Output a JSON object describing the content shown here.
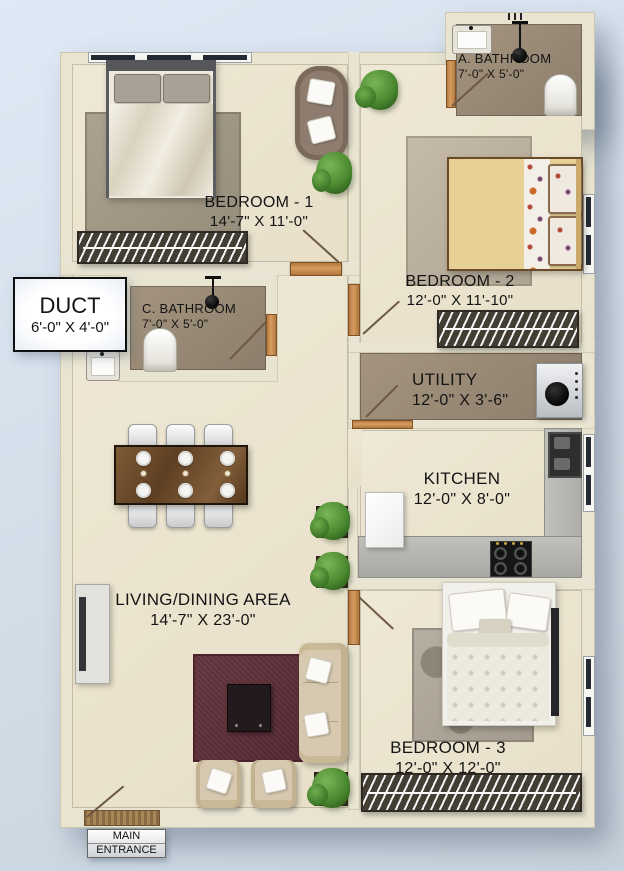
{
  "rooms": [
    {
      "id": "a-bathroom",
      "name": "A. BATHROOM",
      "dims": "7'-0\" X 5'-0\""
    },
    {
      "id": "bedroom-1",
      "name": "BEDROOM - 1",
      "dims": "14'-7\" X 11'-0\""
    },
    {
      "id": "bedroom-2",
      "name": "BEDROOM - 2",
      "dims": "12'-0\" X 11'-10\""
    },
    {
      "id": "duct",
      "name": "DUCT",
      "dims": "6'-0\" X 4'-0\""
    },
    {
      "id": "c-bathroom",
      "name": "C. BATHROOM",
      "dims": "7'-0\" X 5'-0\""
    },
    {
      "id": "utility",
      "name": "UTILITY",
      "dims": "12'-0\" X 3'-6\""
    },
    {
      "id": "kitchen",
      "name": "KITCHEN",
      "dims": "12'-0\" X 8'-0\""
    },
    {
      "id": "living",
      "name": "LIVING/DINING AREA",
      "dims": "14'-7\" X 23'-0\""
    },
    {
      "id": "bedroom-3",
      "name": "BEDROOM - 3",
      "dims": "12'-0\" X 12'-0\""
    }
  ],
  "entrance": {
    "line1": "MAIN",
    "line2": "ENTRANCE"
  },
  "colors": {
    "background": "#d9e3f0",
    "wall": "#e8e4d1",
    "floor_cream": "#ece4cf",
    "floor_bath": "#9b8c7b",
    "door_wood": "#c07f41",
    "rug_living": "#6b3a43",
    "counter_gray": "#b7b5b0",
    "wardrobe_dark": "#443d34",
    "bed2_yellow": "#e6cf96",
    "sofa_cream": "#d8cab1",
    "plant_green": "#4e8f35",
    "label_text": "#141414"
  }
}
